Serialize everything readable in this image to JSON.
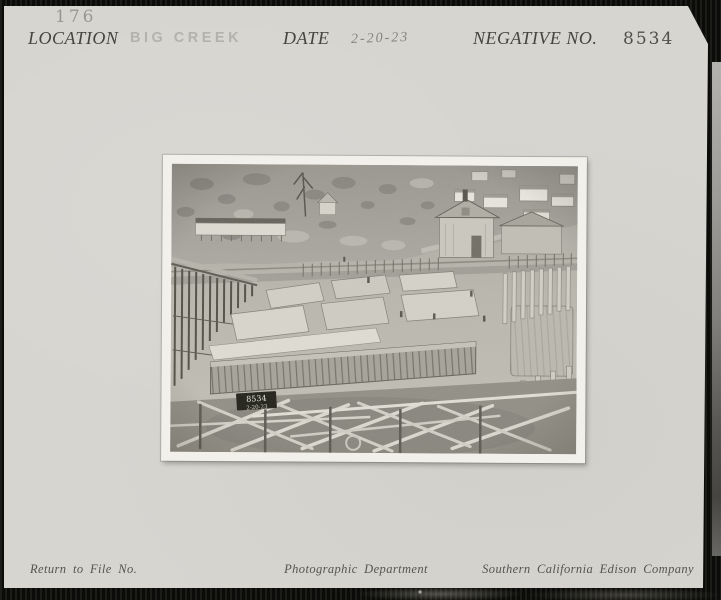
{
  "card": {
    "stamp_number": "176",
    "fields": {
      "location_label": "LOCATION",
      "location_value": "BIG CREEK",
      "date_label": "DATE",
      "date_value": "2-20-23",
      "negative_label": "NEGATIVE NO.",
      "negative_value": "8534"
    },
    "footer": {
      "return_label": "Return to File No.",
      "department": "Photographic Department",
      "company": "Southern California Edison Company"
    }
  },
  "photo": {
    "slate_line1": "8534",
    "slate_line2": "2-20-23"
  },
  "colors": {
    "scan_background": "#0e0e0c",
    "mount_card": "#d7d5d0",
    "photo_border": "#f2f0ea",
    "printed_text": "#45443f",
    "rubber_stamp_text": "#b0aea8",
    "pencil_text": "#85847d"
  }
}
